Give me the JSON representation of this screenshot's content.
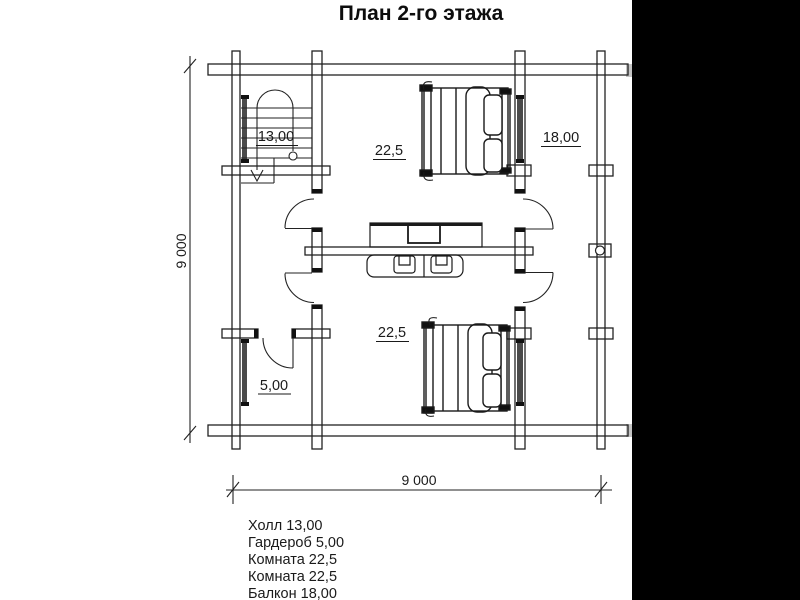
{
  "title": "План 2-го этажа",
  "plan": {
    "labels": {
      "hall": "13,00",
      "room_upper": "22,5",
      "balcony": "18,00",
      "room_lower": "22,5",
      "wardrobe": "5,00"
    },
    "dimensions": {
      "height": "9 000",
      "width": "9 000"
    }
  },
  "legend": {
    "items": [
      "Холл 13,00",
      "Гардероб 5,00",
      "Комната 22,5",
      "Комната 22,5",
      "Балкон 18,00"
    ]
  },
  "colors": {
    "line": "#222222",
    "text": "#1a1a1a",
    "window_fill": "#4a4a4a",
    "letterbox": "#000000"
  }
}
